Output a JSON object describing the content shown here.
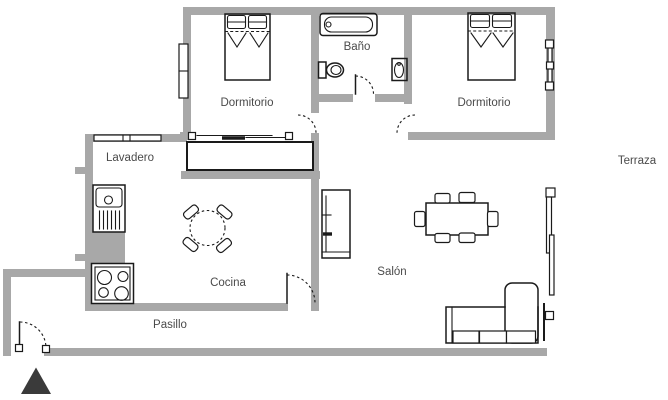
{
  "floorplan": {
    "labels": {
      "dormitorio_left": "Dormitorio",
      "bano": "Baño",
      "dormitorio_right": "Dormitorio",
      "terraza": "Terraza",
      "lavadero": "Lavadero",
      "cocina": "Cocina",
      "salon": "Salón",
      "pasillo": "Pasillo"
    },
    "colors": {
      "wall": "#a8a8a8",
      "line": "#1a1a1a",
      "label_text": "#4a4a4a",
      "entrance_marker": "#3a3a3a",
      "background": "#ffffff"
    }
  }
}
